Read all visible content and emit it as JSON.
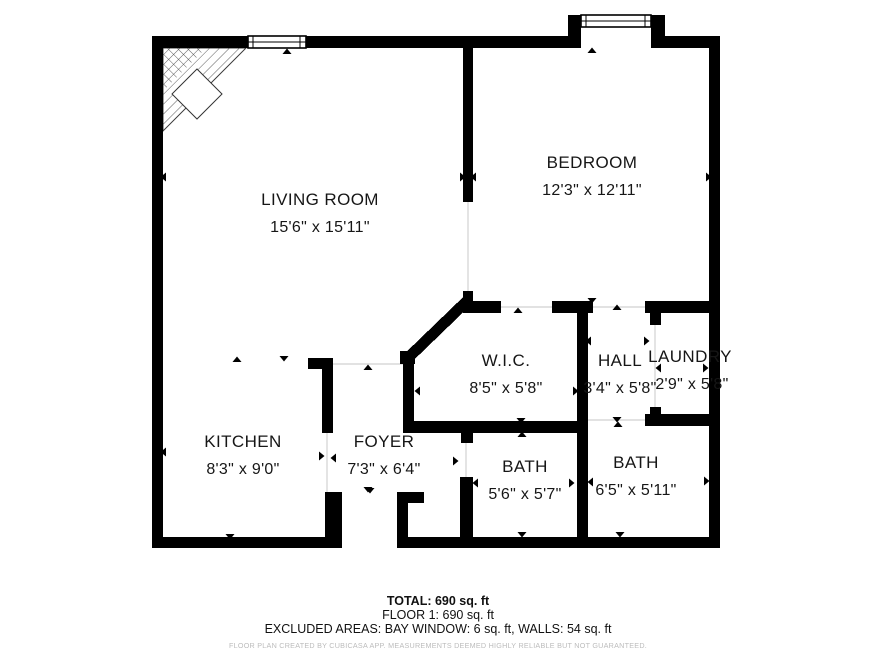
{
  "plan": {
    "rooms": [
      {
        "id": "living-room",
        "name": "LIVING ROOM",
        "dims": "15'6\" x 15'11\""
      },
      {
        "id": "bedroom",
        "name": "BEDROOM",
        "dims": "12'3\" x 12'11\""
      },
      {
        "id": "wic",
        "name": "W.I.C.",
        "dims": "8'5\" x 5'8\""
      },
      {
        "id": "hall",
        "name": "HALL",
        "dims": "3'4\" x 5'8\""
      },
      {
        "id": "laundry",
        "name": "LAUNDRY",
        "dims": "2'9\" x 5'8\""
      },
      {
        "id": "kitchen",
        "name": "KITCHEN",
        "dims": "8'3\" x 9'0\""
      },
      {
        "id": "foyer",
        "name": "FOYER",
        "dims": "7'3\" x 6'4\""
      },
      {
        "id": "bath-1",
        "name": "BATH",
        "dims": "5'6\" x 5'7\""
      },
      {
        "id": "bath-2",
        "name": "BATH",
        "dims": "6'5\" x 5'11\""
      }
    ],
    "features": [
      "window",
      "bay-window",
      "entry-opening",
      "hatched-corner"
    ]
  },
  "summary": {
    "total": "TOTAL: 690 sq. ft",
    "floor": "FLOOR 1: 690 sq. ft",
    "excluded": "EXCLUDED AREAS: BAY WINDOW: 6 sq. ft, WALLS: 54 sq. ft",
    "disclaimer": "FLOOR PLAN CREATED BY CUBICASA APP. MEASUREMENTS DEEMED HIGHLY RELIABLE BUT NOT GUARANTEED."
  },
  "colors": {
    "walls": "#000000",
    "background": "#ffffff",
    "room_text": "#161616",
    "open_boundary_line": "#d9d9d9",
    "disclaimer_text": "#bcbcbc"
  }
}
